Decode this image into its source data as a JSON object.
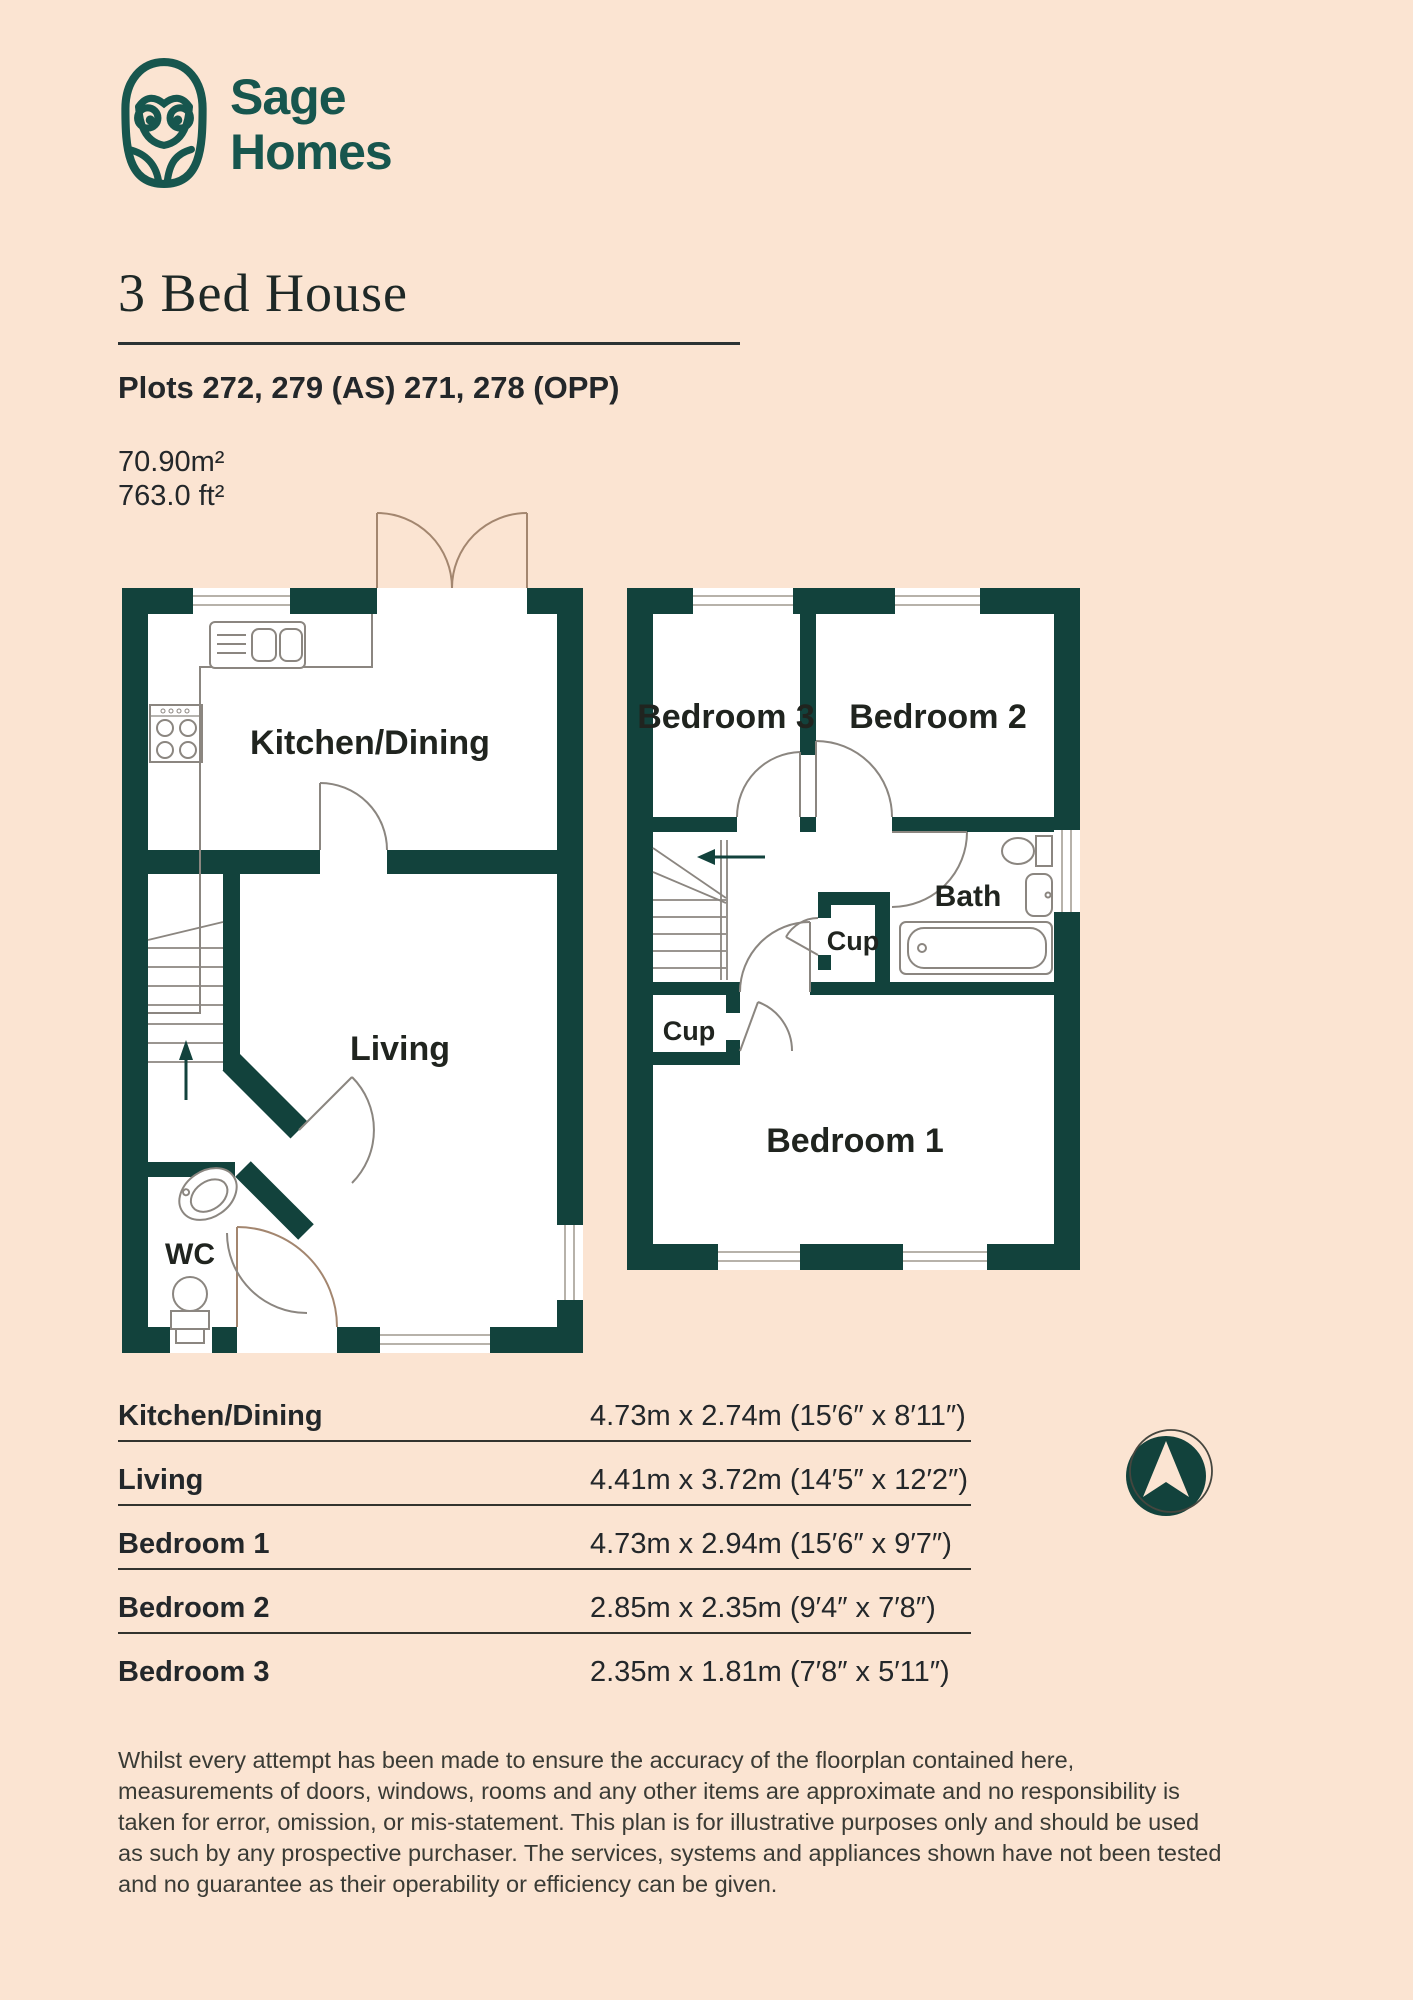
{
  "brand": {
    "logo": "owl-logo",
    "name_line1": "Sage",
    "name_line2": "Homes"
  },
  "header": {
    "title": "3 Bed House",
    "plots": "Plots 272, 279 (AS) 271, 278 (OPP)",
    "area_metric": "70.90m²",
    "area_imperial": "763.0 ft²"
  },
  "floorplan": {
    "ground": {
      "kitchen_dining": "Kitchen/Dining",
      "living": "Living",
      "wc": "WC"
    },
    "first": {
      "bedroom3": "Bedroom 3",
      "bedroom2": "Bedroom 2",
      "bath": "Bath",
      "cup_upper": "Cup",
      "cup_lower": "Cup",
      "bedroom1": "Bedroom 1"
    }
  },
  "dimensions_table": {
    "rows": [
      {
        "room": "Kitchen/Dining",
        "size": "4.73m x 2.74m (15′6″ x 8′11″)"
      },
      {
        "room": "Living",
        "size": "4.41m x 3.72m (14′5″ x 12′2″)"
      },
      {
        "room": "Bedroom 1",
        "size": "4.73m x 2.94m (15′6″ x 9′7″)"
      },
      {
        "room": "Bedroom 2",
        "size": "2.85m x 2.35m (9′4″ x 7′8″)"
      },
      {
        "room": "Bedroom 3",
        "size": "2.35m x 1.81m (7′8″ x 5′11″)"
      }
    ]
  },
  "compass": {
    "icon": "north-arrow"
  },
  "disclaimer": {
    "lines": [
      "Whilst every attempt has been made to ensure the accuracy of the floorplan contained here,",
      "measurements of doors, windows, rooms and any other items are approximate and no responsibility is",
      "taken for error, omission, or mis-statement. This plan is for illustrative purposes only and should be used",
      "as such by any prospective purchaser. The services, systems and appliances shown have not been tested",
      "and no guarantee as their operability or efficiency can be given."
    ]
  },
  "colors": {
    "background": "#fbe4d2",
    "wall_teal": "#12423c",
    "brand_teal": "#17564e",
    "text_dark": "#23272a"
  }
}
